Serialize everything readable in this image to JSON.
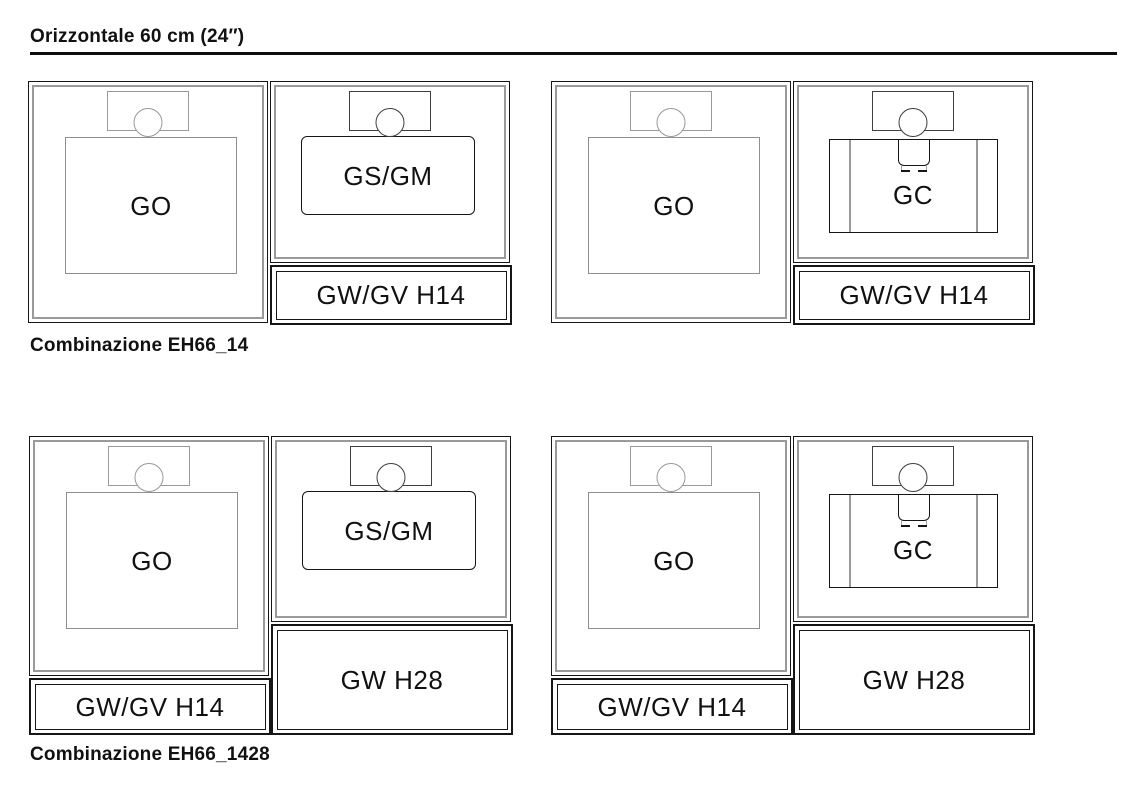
{
  "title": "Orizzontale 60 cm (24″)",
  "sections": [
    {
      "caption": "Combinazione EH66_14",
      "combos": [
        {
          "oven_label": "GO",
          "top_label": "GS/GM",
          "bottom_label": "GW/GV H14"
        },
        {
          "oven_label": "GO",
          "top_label": "GC",
          "bottom_label": "GW/GV H14"
        }
      ]
    },
    {
      "caption": "Combinazione EH66_1428",
      "combos": [
        {
          "oven_label": "GO",
          "oven_drawer_label": "GW/GV H14",
          "top_label": "GS/GM",
          "bottom_label": "GW H28"
        },
        {
          "oven_label": "GO",
          "oven_drawer_label": "GW/GV H14",
          "top_label": "GC",
          "bottom_label": "GW H28"
        }
      ]
    }
  ],
  "colors": {
    "line_dark": "#161616",
    "line_gray": "#9a9a9a",
    "panel_dark": "#3f3f3f",
    "text": "#111111",
    "background": "#ffffff"
  }
}
